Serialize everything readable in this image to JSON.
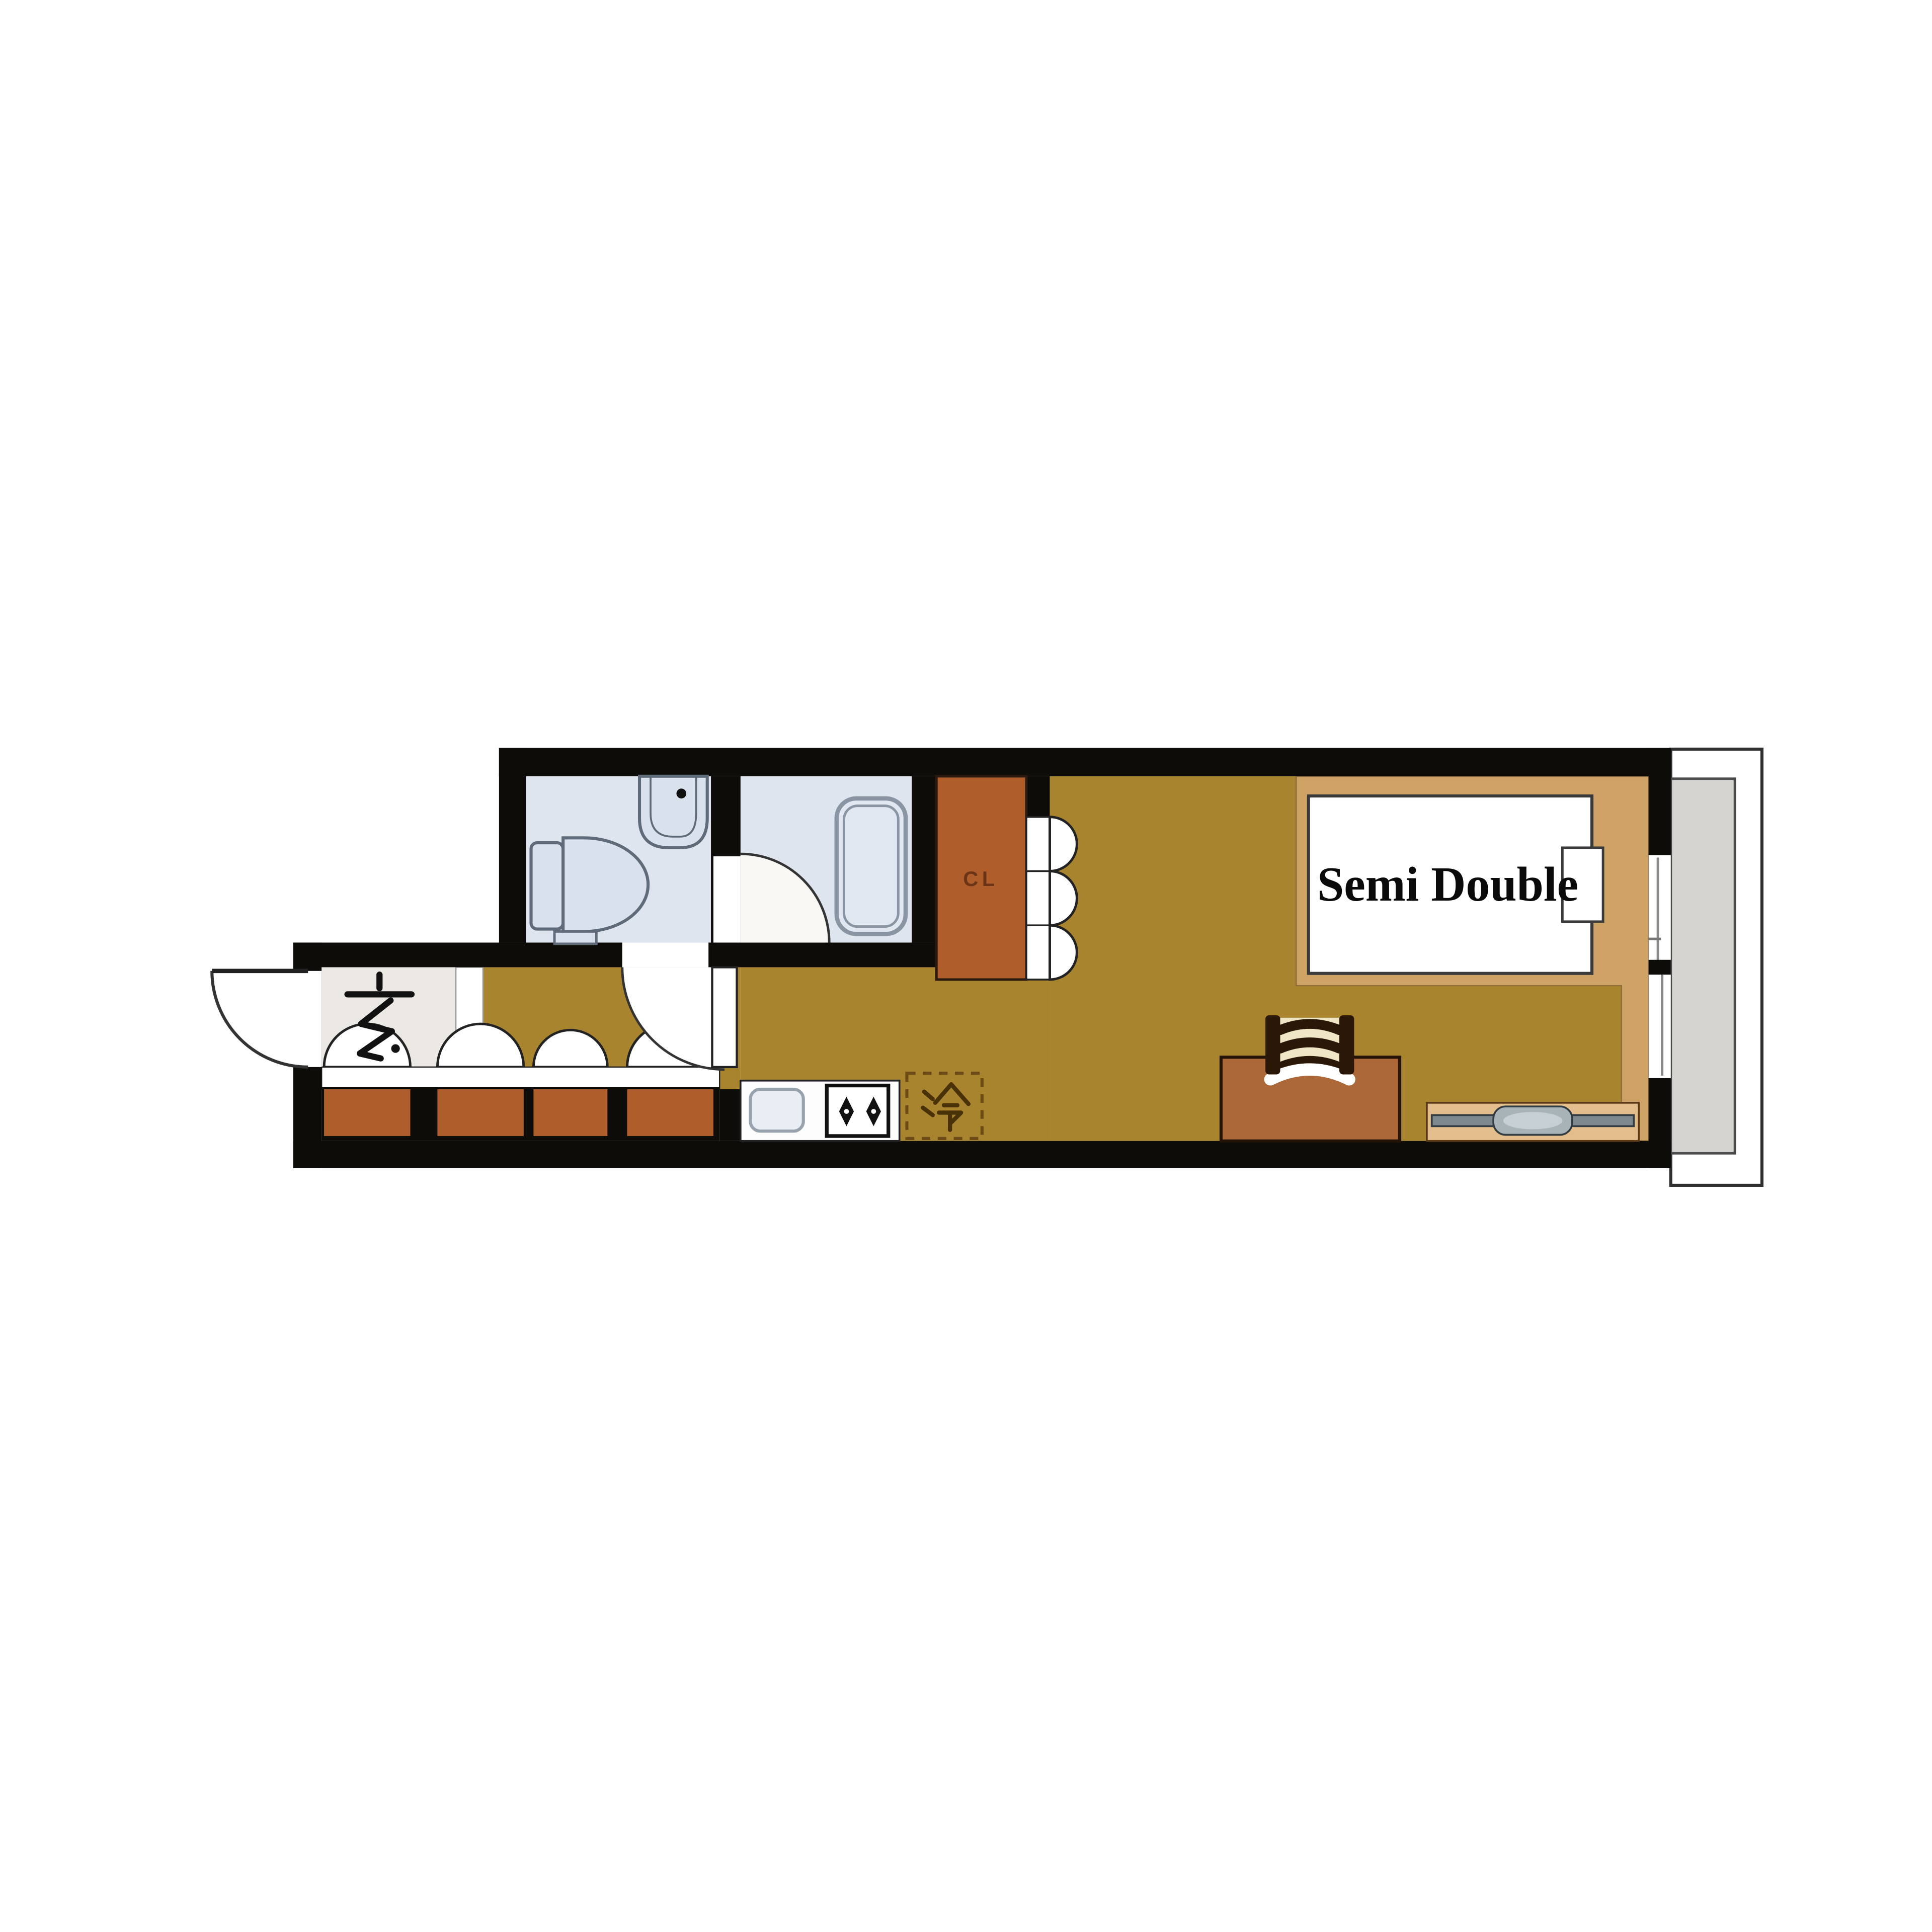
{
  "plan": {
    "bed_label": "Semi Double",
    "entrance_label": "玄",
    "refrigerator_label": "冷",
    "closet_label": "CL"
  },
  "colors": {
    "wall": "#0e0c09",
    "floor_main": "#a8842f",
    "floor_bedroom": "#cfa366",
    "floor_entrance": "#ece9e4",
    "wet_room": "#dee5ee",
    "closet": "#ae5d2b",
    "cabinet": "#ae5d2b",
    "desk": "#ac6838",
    "tv_board": "#e3be8c",
    "balcony_floor": "#d6d4d0",
    "counter": "#fdfdfd",
    "fixture_fill": "#d9e1ec",
    "fixture_stroke": "#5f6b79",
    "fridge_line": "#6b4a16",
    "glyph_brown": "#4a3208"
  }
}
